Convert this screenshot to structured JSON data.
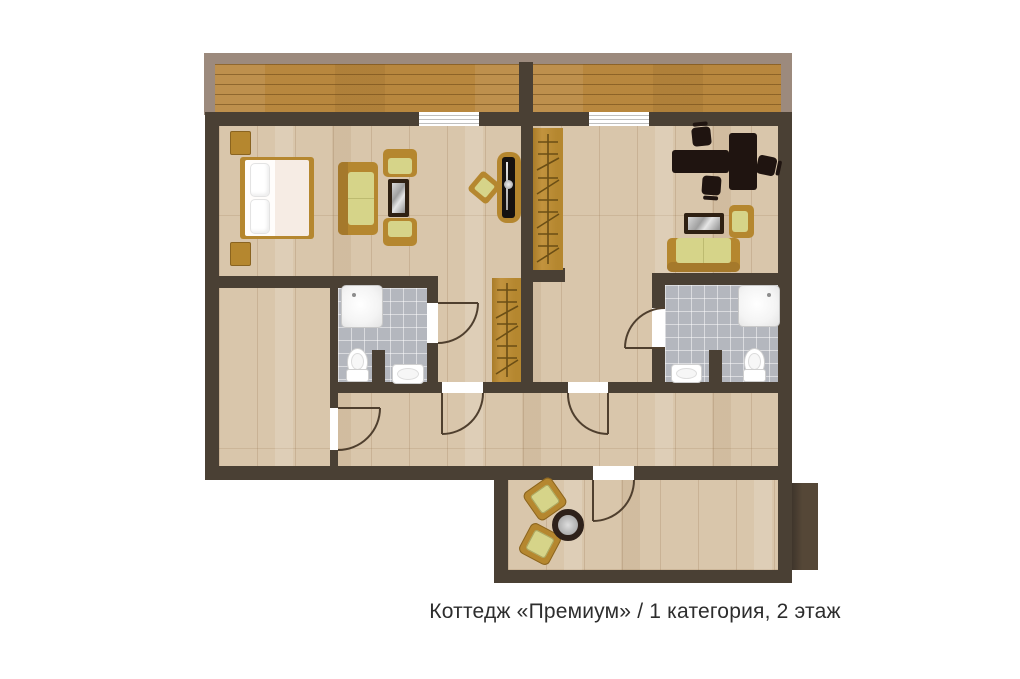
{
  "caption": "Коттедж «Премиум» / 1 категория, 2 этаж",
  "colors": {
    "background": "#ffffff",
    "wall": "#4a4034",
    "floor_wood": "#d9c6ab",
    "balcony_wood": "#b8873e",
    "balcony_border": "#9c8a7d",
    "bathroom_tile": "#b4b7be",
    "furniture_tan": "#b5872f",
    "cushion_green": "#d6d489",
    "desk_dark": "#1f1410",
    "fixture_white": "#ffffff"
  }
}
